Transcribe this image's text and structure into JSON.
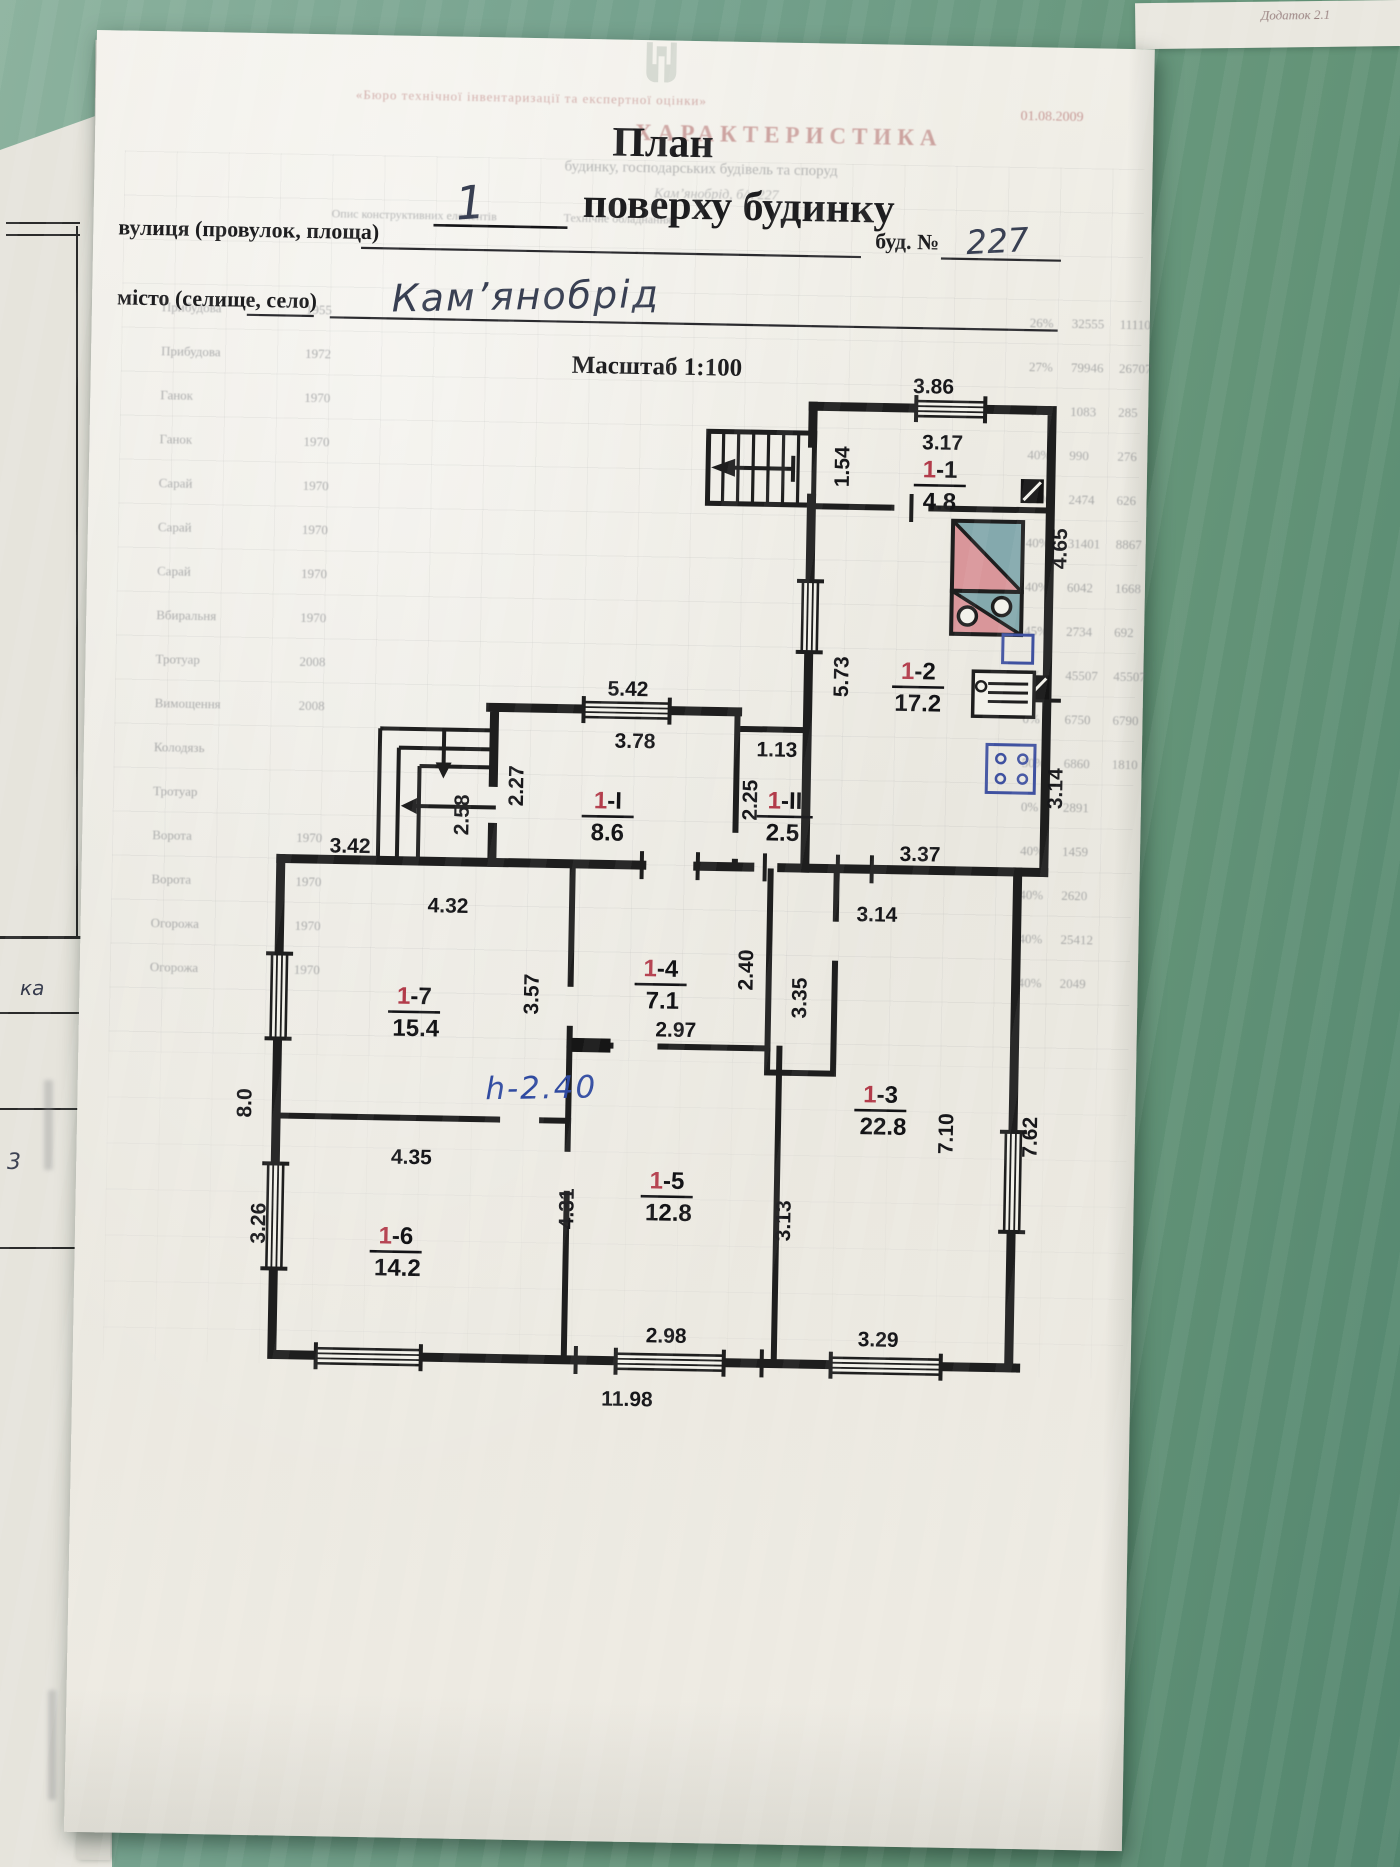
{
  "page": {
    "title": {
      "line1": "План",
      "floor_number": "1",
      "line2": "поверху будинку"
    },
    "fields": {
      "street_label": "вулиця (провулок, площа)",
      "building_no_label": "буд. №",
      "building_no_value": "227",
      "city_label": "місто (селище, село)",
      "city_value": "Кам’янобрід"
    },
    "scale_label": "Масштаб 1:100"
  },
  "plan": {
    "height_note": "h-2.40",
    "rooms": [
      {
        "prefix": "1",
        "suffix": "-1",
        "area": "4.8"
      },
      {
        "prefix": "1",
        "suffix": "-2",
        "area": "17.2"
      },
      {
        "prefix": "1",
        "suffix": "-I",
        "area": "8.6"
      },
      {
        "prefix": "1",
        "suffix": "-II",
        "area": "2.5"
      },
      {
        "prefix": "1",
        "suffix": "-7",
        "area": "15.4"
      },
      {
        "prefix": "1",
        "suffix": "-4",
        "area": "7.1"
      },
      {
        "prefix": "1",
        "suffix": "-3",
        "area": "22.8"
      },
      {
        "prefix": "1",
        "suffix": "-6",
        "area": "14.2"
      },
      {
        "prefix": "1",
        "suffix": "-5",
        "area": "12.8"
      }
    ],
    "dims": {
      "d386": "3.86",
      "d317": "3.17",
      "d154": "1.54",
      "d465": "4.65",
      "d573": "5.73",
      "d314r": "3.14",
      "d337": "3.37",
      "d542": "5.42",
      "d378": "3.78",
      "d227": "2.27",
      "d258": "2.58",
      "d113": "1.13",
      "d225": "2.25",
      "d342": "3.42",
      "d432": "4.32",
      "d357": "3.57",
      "d297": "2.97",
      "d240": "2.40",
      "d335": "3.35",
      "d314t": "3.14",
      "d80": "8.0",
      "d435": "4.35",
      "d326": "3.26",
      "d431": "4.31",
      "d298": "2.98",
      "d313": "3.13",
      "d329": "3.29",
      "d710": "7.10",
      "d762": "7.62",
      "d1198": "11.98"
    }
  },
  "side_sheet": {
    "fragment_ka": "ка",
    "fragment_3": "3"
  },
  "corner_note": "Додаток 2.1",
  "bleedthrough": {
    "org_line": "«Бюро технічної інвентаризації та експертної оцінки»",
    "title": "ХАРАКТЕРИСТИКА",
    "subtitle": "будинку, господарських будівель та споруд",
    "date": "01.08.2009",
    "address_fragment": "Кам’янобрід, б/н 227",
    "col_header1": "Опис конструктивних елементів",
    "col_header2": "Технічне обладнання",
    "rows": [
      {
        "label": "Прибудова",
        "year": "1955",
        "pct": "26%",
        "n1": "32555",
        "n2": "11110"
      },
      {
        "label": "Прибудова",
        "year": "1972",
        "pct": "27%",
        "n1": "79946",
        "n2": "26707"
      },
      {
        "label": "Ганок",
        "year": "1970",
        "pct": "40%",
        "n1": "1083",
        "n2": "285"
      },
      {
        "label": "Ганок",
        "year": "1970",
        "pct": "40%",
        "n1": "990",
        "n2": "276"
      },
      {
        "label": "Сарай",
        "year": "1970",
        "pct": "54%",
        "n1": "2474",
        "n2": "626"
      },
      {
        "label": "Сарай",
        "year": "1970",
        "pct": "40%",
        "n1": "31401",
        "n2": "8867"
      },
      {
        "label": "Сарай",
        "year": "1970",
        "pct": "40%",
        "n1": "6042",
        "n2": "1668"
      },
      {
        "label": "Вбиральня",
        "year": "1970",
        "pct": "45%",
        "n1": "2734",
        "n2": "692"
      },
      {
        "label": "Тротуар",
        "year": "2008",
        "pct": "0%",
        "n1": "45507",
        "n2": "45507"
      },
      {
        "label": "Вимощення",
        "year": "2008",
        "pct": "0%",
        "n1": "6750",
        "n2": "6790"
      },
      {
        "label": "Колодязь",
        "year": "",
        "pct": "50%",
        "n1": "6860",
        "n2": "1810"
      },
      {
        "label": "Тротуар",
        "year": "",
        "pct": "0%",
        "n1": "2891",
        "n2": ""
      },
      {
        "label": "Ворота",
        "year": "1970",
        "pct": "40%",
        "n1": "1459",
        "n2": ""
      },
      {
        "label": "Ворота",
        "year": "1970",
        "pct": "40%",
        "n1": "2620",
        "n2": ""
      },
      {
        "label": "Огорожа",
        "year": "1970",
        "pct": "40%",
        "n1": "25412",
        "n2": ""
      },
      {
        "label": "Огорожа",
        "year": "1970",
        "pct": "40%",
        "n1": "2049",
        "n2": ""
      }
    ]
  }
}
